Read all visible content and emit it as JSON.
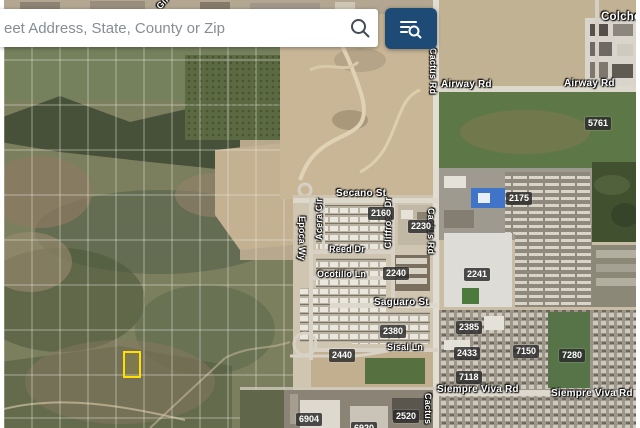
{
  "search_bar": {
    "placeholder": "eet Address, State, County or Zip",
    "search_icon": "magnifier-icon",
    "layers_button_icon": "filter-search-icon",
    "button_color": "#1d4b76"
  },
  "map": {
    "view_type": "satellite",
    "selected_parcel_highlight_color": "#ffe000",
    "road_labels": {
      "colchester": "Colchester",
      "airway": "Airway Rd",
      "cactus": "Cactus Rd",
      "cactus_short": "Cactus",
      "secano": "Secano St",
      "acera": "Acera Cir",
      "cliffrose": "Cliffrose Dr",
      "epoca": "Epoca Wy",
      "reed": "Reed Dr",
      "ocotillo": "Ocotillo Ln",
      "saguaro": "Saguaro St",
      "sisal": "Sisal Ln",
      "siempre": "Siempre Viva Rd",
      "gil": "Gil"
    },
    "parcel_numbers": {
      "5761": "5761",
      "2175": "2175",
      "2160": "2160",
      "2230": "2230",
      "2240": "2240",
      "2241": "2241",
      "2380": "2380",
      "2385": "2385",
      "2440": "2440",
      "2433": "2433",
      "7150": "7150",
      "7280": "7280",
      "7118": "7118",
      "2520": "2520",
      "6904": "6904",
      "6920": "6920"
    }
  }
}
